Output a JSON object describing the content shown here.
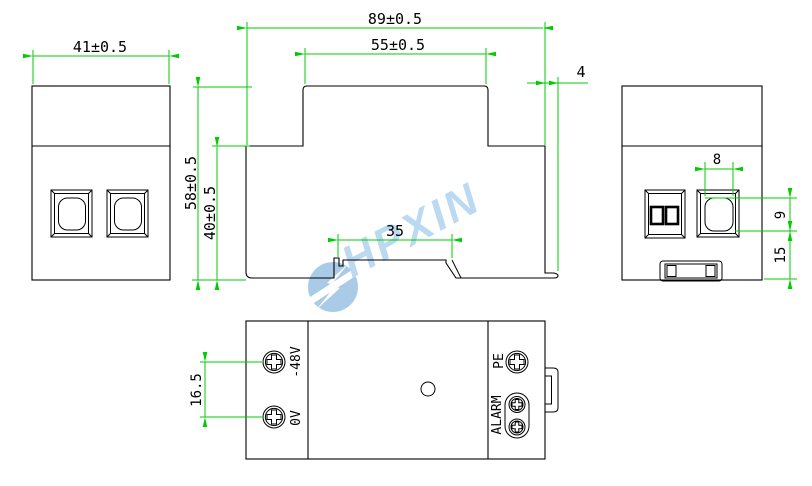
{
  "watermark": {
    "text": "HPXIN",
    "logo": "lightning-bolt-circle"
  },
  "colors": {
    "outline": "#000000",
    "dimension": "#00cc00",
    "watermark_text": "#bcd9f2",
    "watermark_logo": "#a9cbe8"
  },
  "dimensions": {
    "front_width": "41±0.5",
    "overall_width": "89±0.5",
    "top_width": "55±0.5",
    "overall_height": "58±0.5",
    "body_height": "40±0.5",
    "rail_slot_width": "35",
    "clip_protrusion": "4",
    "window_width": "8",
    "window_height": "9",
    "window_bottom_offset": "15",
    "terminal_spacing": "16.5"
  },
  "terminals": {
    "neg48": "-48V",
    "zero": "0V",
    "pe": "PE",
    "alarm": "ALARM"
  }
}
